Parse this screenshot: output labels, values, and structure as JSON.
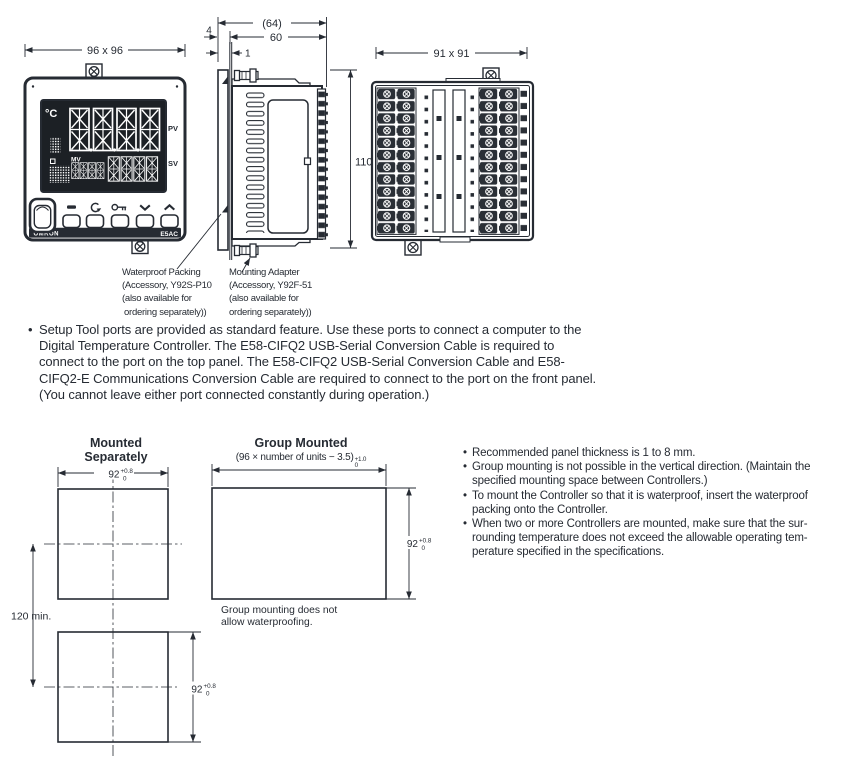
{
  "drawing": {
    "front": {
      "dim": "96 x 96",
      "unit": "°C",
      "pv": "PV",
      "sv": "SV",
      "mv": "MV",
      "brand": "OMRON",
      "model": "E5AC"
    },
    "side": {
      "total_depth": "(64)",
      "body_depth": "60",
      "bezel_depth": "4",
      "panel_thickness": "1",
      "height": "110"
    },
    "rear": {
      "dim": "91 x 91"
    }
  },
  "callouts": {
    "waterproof_packing": {
      "l0": "Waterproof Packing",
      "l1": "(Accessory, Y92S-P10",
      "l2": "(also available for",
      "l3": "ordering separately))"
    },
    "mounting_adapter": {
      "l0": "Mounting Adapter",
      "l1": "(Accessory, Y92F-51",
      "l2": "(also available for",
      "l3": "ordering separately))"
    }
  },
  "setup_note": {
    "bullet": "•",
    "lines": {
      "l0": "Setup Tool ports are provided as standard feature. Use these ports to connect a computer to the",
      "l1": "Digital Temperature Controller. The E58-CIFQ2 USB-Serial Conversion Cable is required to",
      "l2": "connect to the port on the top panel. The E58-CIFQ2 USB-Serial Conversion Cable and E58-",
      "l3": "CIFQ2-E Communications Conversion Cable are required to connect to the port on the front panel.",
      "l4": "(You cannot leave either port connected constantly during operation.)"
    }
  },
  "mounting": {
    "separately_title": "Mounted Separately",
    "group_title": "Group Mounted",
    "group_formula": "(96 × number of units − 3.5)",
    "group_tol_plus": "+1.0",
    "group_tol_minus": "0",
    "cutout_mm": "92",
    "cutout_tol_plus": "+0.8",
    "cutout_tol_minus": "0",
    "spacing": "120 min.",
    "group_note": {
      "l0": "Group mounting does not",
      "l1": "allow waterproofing."
    }
  },
  "notes": {
    "bullet": "•",
    "item0": {
      "l0": "Recommended panel thickness is 1 to 8 mm."
    },
    "item1": {
      "l0": "Group mounting is not possible in the vertical direction. (Maintain the",
      "l1": "specified mounting space between Controllers.)"
    },
    "item2": {
      "l0": "To mount the Controller so that it is waterproof, insert the waterproof",
      "l1": "packing onto the Controller."
    },
    "item3": {
      "l0": "When two or more Controllers are mounted, make sure that the sur-",
      "l1": "rounding temperature does not exceed the allowable operating tem-",
      "l2": "perature specified in the specifications."
    }
  }
}
